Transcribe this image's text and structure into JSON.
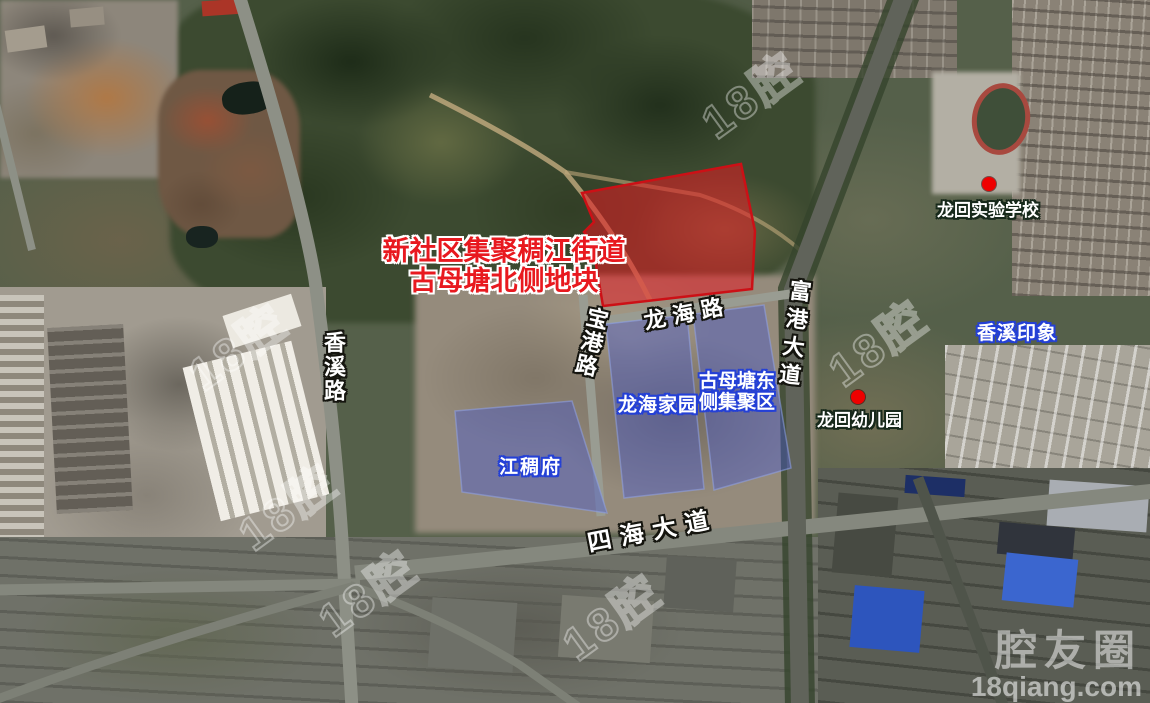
{
  "title_overlay": {
    "line1": "新社区集聚稠江街道",
    "line2": "古母塘北侧地块"
  },
  "road_labels": {
    "xiangxi_road": "香溪路",
    "baogang_road": "宝港路",
    "longhai_road": "龙海路",
    "fugang_avenue": "富港大道",
    "sihai_avenue": "四海大道"
  },
  "area_labels": {
    "jiangchou_fu": "江稠府",
    "longhai_jiayuan": "龙海家园",
    "gumutang_east_line1": "古母塘东",
    "gumutang_east_line2": "侧集聚区",
    "xiangxi_yinxiang": "香溪印象"
  },
  "poi_labels": {
    "longhui_school": "龙回实验学校",
    "longhui_kindergarten": "龙回幼儿园"
  },
  "watermarks": {
    "brand": "腔友圈",
    "site": "18qiang.com",
    "tile": "18腔"
  },
  "legend_colors": {
    "target_parcel_fill": "#e51c23",
    "target_parcel_stroke": "#cc1016",
    "cluster_parcel_fill": "#4558cf",
    "cluster_label_outline": "#2440d6",
    "poi_marker_red": "#ee0000",
    "road_label_text": "#ffffff",
    "title_red": "#e8191f"
  }
}
